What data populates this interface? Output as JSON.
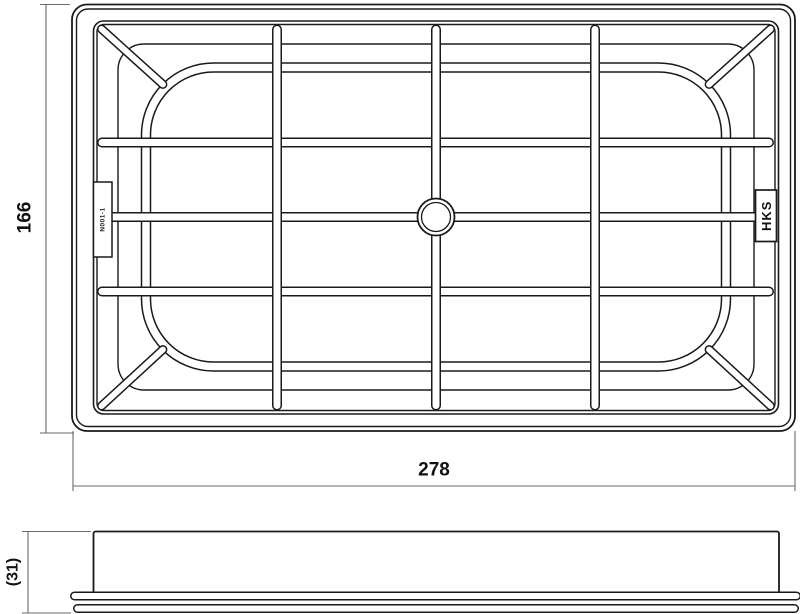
{
  "drawing": {
    "background": "#ffffff",
    "object_line_color": "#1a1a1a",
    "dimension_line_color": "#6a6a6a",
    "views": {
      "top": {
        "description": "air filter element, plan view with support grid",
        "brand_badge_label": "HKS",
        "part_tab_label": "N001-1",
        "dimensions": {
          "width": "278",
          "height": "166"
        }
      },
      "side": {
        "description": "air filter element, side profile with flange",
        "dimensions": {
          "height": "(31)"
        }
      }
    }
  }
}
